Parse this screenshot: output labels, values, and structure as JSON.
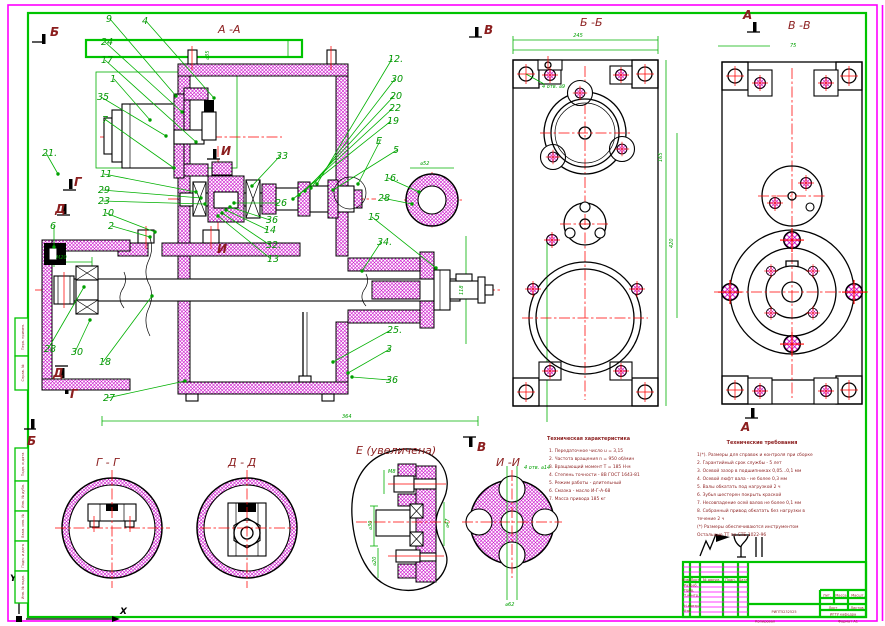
{
  "sheet": {
    "axis_x_label": "X",
    "axis_y_label": "Y"
  },
  "view_labels": [
    {
      "t": "А -А",
      "x": 218,
      "y": 33
    },
    {
      "t": "Б -Б",
      "x": 580,
      "y": 26
    },
    {
      "t": "В -В",
      "x": 788,
      "y": 29
    },
    {
      "t": "Г - Г",
      "x": 96,
      "y": 466
    },
    {
      "t": "Д - Д",
      "x": 228,
      "y": 466
    },
    {
      "t": "Е  (увеличена)",
      "x": 356,
      "y": 454
    },
    {
      "t": "И -И",
      "x": 496,
      "y": 466
    }
  ],
  "section_markers": [
    {
      "t": "Б",
      "x": 50,
      "y": 36
    },
    {
      "t": "Б",
      "x": 27,
      "y": 445
    },
    {
      "t": "Г",
      "x": 74,
      "y": 186
    },
    {
      "t": "Г",
      "x": 70,
      "y": 398
    },
    {
      "t": "Д",
      "x": 55,
      "y": 213
    },
    {
      "t": "Д",
      "x": 53,
      "y": 377
    },
    {
      "t": "И",
      "x": 221,
      "y": 155
    },
    {
      "t": "И",
      "x": 217,
      "y": 253
    },
    {
      "t": "В",
      "x": 484,
      "y": 34
    },
    {
      "t": "В",
      "x": 477,
      "y": 451
    },
    {
      "t": "А",
      "x": 743,
      "y": 19
    },
    {
      "t": "А",
      "x": 741,
      "y": 431
    }
  ],
  "callouts": [
    {
      "n": "9",
      "x": 106,
      "y": 22,
      "tx": 176,
      "ty": 96
    },
    {
      "n": "4",
      "x": 142,
      "y": 24,
      "tx": 214,
      "ty": 98
    },
    {
      "n": "24",
      "x": 101,
      "y": 45,
      "tx": 182,
      "ty": 112
    },
    {
      "n": "17",
      "x": 101,
      "y": 63,
      "tx": 196,
      "ty": 142
    },
    {
      "n": "1",
      "x": 110,
      "y": 82,
      "tx": 150,
      "ty": 120
    },
    {
      "n": "35",
      "x": 97,
      "y": 100,
      "tx": 166,
      "ty": 136
    },
    {
      "n": "7",
      "x": 102,
      "y": 123,
      "tx": 174,
      "ty": 168
    },
    {
      "n": "21.",
      "x": 42,
      "y": 156,
      "tx": 58,
      "ty": 174
    },
    {
      "n": "11",
      "x": 100,
      "y": 177,
      "tx": 196,
      "ty": 192
    },
    {
      "n": "29",
      "x": 98,
      "y": 193,
      "tx": 201,
      "ty": 198
    },
    {
      "n": "23",
      "x": 98,
      "y": 204,
      "tx": 205,
      "ty": 204
    },
    {
      "n": "10",
      "x": 102,
      "y": 216,
      "tx": 155,
      "ty": 232
    },
    {
      "n": "6",
      "x": 50,
      "y": 229,
      "tx": 54,
      "ty": 247
    },
    {
      "n": "2",
      "x": 108,
      "y": 229,
      "tx": 150,
      "ty": 237
    },
    {
      "n": "12.",
      "x": 388,
      "y": 62,
      "tx": 317,
      "ty": 184
    },
    {
      "n": "30",
      "x": 391,
      "y": 82,
      "tx": 311,
      "ty": 188
    },
    {
      "n": "20",
      "x": 390,
      "y": 99,
      "tx": 305,
      "ty": 191
    },
    {
      "n": "22",
      "x": 389,
      "y": 111,
      "tx": 299,
      "ty": 195
    },
    {
      "n": "19",
      "x": 387,
      "y": 124,
      "tx": 293,
      "ty": 199
    },
    {
      "n": "Е",
      "x": 376,
      "y": 144,
      "tx": 358,
      "ty": 184
    },
    {
      "n": "5",
      "x": 393,
      "y": 153,
      "tx": 333,
      "ty": 190
    },
    {
      "n": "16.",
      "x": 384,
      "y": 181,
      "tx": 419,
      "ty": 192
    },
    {
      "n": "28",
      "x": 378,
      "y": 201,
      "tx": 412,
      "ty": 204
    },
    {
      "n": "33",
      "x": 276,
      "y": 159,
      "tx": 252,
      "ty": 186
    },
    {
      "n": "26",
      "x": 275,
      "y": 206,
      "tx": 234,
      "ty": 203
    },
    {
      "n": "36",
      "x": 266,
      "y": 223,
      "tx": 230,
      "ty": 207
    },
    {
      "n": "14",
      "x": 264,
      "y": 233,
      "tx": 226,
      "ty": 210
    },
    {
      "n": "32.",
      "x": 266,
      "y": 248,
      "tx": 222,
      "ty": 213
    },
    {
      "n": "13",
      "x": 267,
      "y": 262,
      "tx": 218,
      "ty": 216
    },
    {
      "n": "15",
      "x": 368,
      "y": 220,
      "tx": 436,
      "ty": 268
    },
    {
      "n": "34.",
      "x": 377,
      "y": 245,
      "tx": 362,
      "ty": 271
    },
    {
      "n": "28",
      "x": 44,
      "y": 352,
      "tx": 84,
      "ty": 287
    },
    {
      "n": "30",
      "x": 71,
      "y": 355,
      "tx": 90,
      "ty": 320
    },
    {
      "n": "18",
      "x": 99,
      "y": 365,
      "tx": 152,
      "ty": 296
    },
    {
      "n": "27",
      "x": 103,
      "y": 401,
      "tx": 185,
      "ty": 381
    },
    {
      "n": "25.",
      "x": 387,
      "y": 333,
      "tx": 333,
      "ty": 362
    },
    {
      "n": "3",
      "x": 386,
      "y": 352,
      "tx": 348,
      "ty": 373
    },
    {
      "n": "36",
      "x": 386,
      "y": 383,
      "tx": 352,
      "ty": 377
    }
  ],
  "dim_labels": [
    {
      "t": "245",
      "x": 578,
      "y": 37,
      "a": "middle"
    },
    {
      "t": "165",
      "x": 662,
      "y": 162,
      "r": -90
    },
    {
      "t": "420",
      "x": 673,
      "y": 248,
      "r": -90
    },
    {
      "t": "4 отв. ⌀9",
      "x": 542,
      "y": 88
    },
    {
      "t": "75",
      "x": 790,
      "y": 47
    },
    {
      "t": "⌀52",
      "x": 420,
      "y": 165
    },
    {
      "t": "118",
      "x": 463,
      "y": 295,
      "r": -90
    },
    {
      "t": "M20",
      "x": 56,
      "y": 259
    },
    {
      "t": "364",
      "x": 342,
      "y": 418
    },
    {
      "t": "⌀62",
      "x": 505,
      "y": 606
    },
    {
      "t": "4 отв. ⌀14",
      "x": 524,
      "y": 469
    },
    {
      "t": "⌀30",
      "x": 372,
      "y": 530,
      "r": -90
    },
    {
      "t": "M8",
      "x": 388,
      "y": 473
    },
    {
      "t": "⌀47",
      "x": 449,
      "y": 528,
      "r": -90
    },
    {
      "t": "⌀20",
      "x": 376,
      "y": 566,
      "r": -90
    },
    {
      "t": "⌀35",
      "x": 209,
      "y": 60,
      "r": -90
    }
  ],
  "tech_characteristics": {
    "header": "Техническая характеристика",
    "header_x": 547,
    "header_y": 440,
    "lines_x": 549,
    "lines_y": 452,
    "lines": [
      "1. Передаточное число u = 3,15",
      "2. Частота вращения n = 950 об/мин",
      "3. Вращающий момент Т = 185 Н·м",
      "4. Степень точности - 8В ГОСТ 1643-81",
      "5. Режим работы - длительный",
      "6. Смазка - масло И-Г-А-68",
      "7. Масса привода 185 кг"
    ]
  },
  "tech_requirements": {
    "header": "Технические требования",
    "header_x": 762,
    "header_y": 444,
    "header_anchor": "middle",
    "lines_x": 697,
    "lines_y": 456,
    "lines": [
      "1(*). Размеры для справок и контроля при сборке",
      "2. Гарантийный срок службы - 5 лет",
      "3. Осевой зазор в подшипниках 0,05...0,1 мм",
      "4. Осевой люфт вала - не более 0,3 мм",
      "5. Валы обкатать под нагрузкой 2 ч",
      "6. Зубья шестерен покрыть краской",
      "7. Несовпадение осей валов не более 0,1 мм",
      "8. Собранный привод обкатать без нагрузки в",
      "    течение 2 ч",
      "(*) Размеры обеспечиваются инструментом",
      "Остальные ТТ по СТБ 1022-96"
    ]
  },
  "left_stamps": [
    {
      "y": 318,
      "h": 38,
      "t": "Перв. примен."
    },
    {
      "y": 356,
      "h": 34,
      "t": "Справ. №"
    },
    {
      "y": 448,
      "h": 33,
      "t": "Подп. и дата"
    },
    {
      "y": 481,
      "h": 30,
      "t": "Инв. № дубл."
    },
    {
      "y": 511,
      "h": 30,
      "t": "Взам. инв. №"
    },
    {
      "y": 541,
      "h": 30,
      "t": "Подп. и дата"
    },
    {
      "y": 571,
      "h": 32,
      "t": "Инв. № подл."
    }
  ],
  "title_block": {
    "designation": "РИПТ5232525",
    "organization": "ИГТУ кафедра",
    "below_left": "Копировал",
    "below_right": "Формат A1",
    "labels": [
      {
        "t": "Изм.",
        "x": 686.5,
        "y": 581,
        "a": "middle"
      },
      {
        "t": "Лист",
        "x": 695,
        "y": 581,
        "a": "middle"
      },
      {
        "t": "№ докум.",
        "x": 711.5,
        "y": 581,
        "a": "middle"
      },
      {
        "t": "Подп.",
        "x": 730.5,
        "y": 581,
        "a": "middle"
      },
      {
        "t": "Дата",
        "x": 743,
        "y": 581,
        "a": "middle"
      },
      {
        "t": "Разраб.",
        "x": 684,
        "y": 586.5
      },
      {
        "t": "Пров.",
        "x": 684,
        "y": 591.5
      },
      {
        "t": "Т.контр.",
        "x": 684,
        "y": 596.5
      },
      {
        "t": "Н.контр.",
        "x": 684,
        "y": 607
      },
      {
        "t": "Утв.",
        "x": 684,
        "y": 612
      },
      {
        "t": "Лит.",
        "x": 827,
        "y": 596.5,
        "a": "middle"
      },
      {
        "t": "Масса",
        "x": 841,
        "y": 596.5,
        "a": "middle"
      },
      {
        "t": "Масшт.",
        "x": 858,
        "y": 596.5,
        "a": "middle"
      },
      {
        "t": "Лист",
        "x": 833,
        "y": 609,
        "a": "middle"
      },
      {
        "t": "Листов",
        "x": 857,
        "y": 609,
        "a": "middle"
      }
    ]
  }
}
